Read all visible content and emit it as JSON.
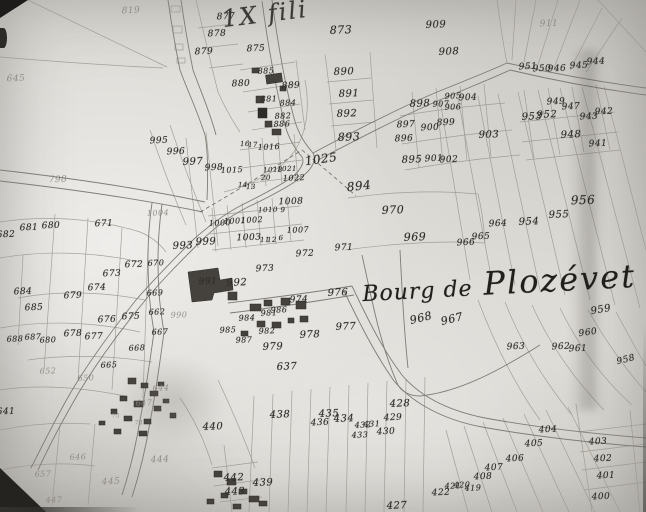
{
  "map": {
    "annotation_top": "1X fili",
    "place_label": {
      "prefix": "Bourg de",
      "name": "Plozévet"
    },
    "colors": {
      "paper": "#dedcd7",
      "ink": "#2f2d29",
      "faint": "#85827b",
      "line": "#98958c",
      "road": "#7f7c75"
    },
    "parcel_numbers": [
      {
        "t": "819",
        "x": 131,
        "y": 11,
        "f": true
      },
      {
        "t": "877",
        "x": 226,
        "y": 17
      },
      {
        "t": "873",
        "x": 341,
        "y": 30,
        "s": 11
      },
      {
        "t": "878",
        "x": 217,
        "y": 34
      },
      {
        "t": "875",
        "x": 256,
        "y": 49
      },
      {
        "t": "879",
        "x": 204,
        "y": 52
      },
      {
        "t": "909",
        "x": 436,
        "y": 25,
        "s": 10
      },
      {
        "t": "911",
        "x": 549,
        "y": 24,
        "f": true
      },
      {
        "t": "908",
        "x": 449,
        "y": 52,
        "s": 10
      },
      {
        "t": "645",
        "x": 16,
        "y": 79,
        "f": true
      },
      {
        "t": "890",
        "x": 344,
        "y": 72,
        "s": 10
      },
      {
        "t": "885",
        "x": 266,
        "y": 71,
        "s": 8
      },
      {
        "t": "880",
        "x": 241,
        "y": 84
      },
      {
        "t": "889",
        "x": 291,
        "y": 86
      },
      {
        "t": "881",
        "x": 269,
        "y": 99,
        "s": 8
      },
      {
        "t": "884",
        "x": 288,
        "y": 103,
        "s": 8
      },
      {
        "t": "882",
        "x": 283,
        "y": 116,
        "s": 8
      },
      {
        "t": "886",
        "x": 282,
        "y": 124,
        "s": 8
      },
      {
        "t": "891",
        "x": 349,
        "y": 94,
        "s": 10
      },
      {
        "t": "892",
        "x": 347,
        "y": 114,
        "s": 10
      },
      {
        "t": "893",
        "x": 349,
        "y": 137,
        "s": 11
      },
      {
        "t": "951",
        "x": 528,
        "y": 67
      },
      {
        "t": "950",
        "x": 542,
        "y": 69
      },
      {
        "t": "946",
        "x": 557,
        "y": 69
      },
      {
        "t": "945",
        "x": 579,
        "y": 66
      },
      {
        "t": "944",
        "x": 596,
        "y": 62
      },
      {
        "t": "949",
        "x": 556,
        "y": 102
      },
      {
        "t": "947",
        "x": 571,
        "y": 107
      },
      {
        "t": "953",
        "x": 532,
        "y": 117,
        "s": 10
      },
      {
        "t": "952",
        "x": 547,
        "y": 115,
        "s": 10
      },
      {
        "t": "943",
        "x": 589,
        "y": 117
      },
      {
        "t": "942",
        "x": 604,
        "y": 112
      },
      {
        "t": "948",
        "x": 571,
        "y": 135,
        "s": 10
      },
      {
        "t": "941",
        "x": 598,
        "y": 144
      },
      {
        "t": "898",
        "x": 420,
        "y": 104,
        "s": 10
      },
      {
        "t": "905",
        "x": 453,
        "y": 96,
        "s": 8
      },
      {
        "t": "904",
        "x": 468,
        "y": 98
      },
      {
        "t": "907",
        "x": 441,
        "y": 104,
        "s": 8
      },
      {
        "t": "906",
        "x": 453,
        "y": 107,
        "s": 8
      },
      {
        "t": "897",
        "x": 406,
        "y": 125
      },
      {
        "t": "899",
        "x": 446,
        "y": 123
      },
      {
        "t": "900",
        "x": 430,
        "y": 128
      },
      {
        "t": "896",
        "x": 404,
        "y": 139
      },
      {
        "t": "903",
        "x": 489,
        "y": 135,
        "s": 10
      },
      {
        "t": "895",
        "x": 412,
        "y": 160,
        "s": 10
      },
      {
        "t": "901",
        "x": 434,
        "y": 159
      },
      {
        "t": "902",
        "x": 449,
        "y": 160
      },
      {
        "t": "1025",
        "x": 321,
        "y": 159,
        "s": 12,
        "r": -8
      },
      {
        "t": "894",
        "x": 359,
        "y": 186,
        "s": 12,
        "r": -6
      },
      {
        "t": "995",
        "x": 159,
        "y": 141
      },
      {
        "t": "996",
        "x": 176,
        "y": 152
      },
      {
        "t": "997",
        "x": 193,
        "y": 162,
        "s": 10
      },
      {
        "t": "998",
        "x": 214,
        "y": 168
      },
      {
        "t": "1015",
        "x": 232,
        "y": 170,
        "s": 8
      },
      {
        "t": "16",
        "x": 245,
        "y": 144,
        "s": 7
      },
      {
        "t": "17",
        "x": 253,
        "y": 145,
        "s": 7
      },
      {
        "t": "1016",
        "x": 269,
        "y": 147,
        "s": 8
      },
      {
        "t": "1018",
        "x": 273,
        "y": 170,
        "s": 7
      },
      {
        "t": "1021",
        "x": 287,
        "y": 169,
        "s": 7
      },
      {
        "t": "20",
        "x": 266,
        "y": 178,
        "s": 7
      },
      {
        "t": "1022",
        "x": 294,
        "y": 178,
        "s": 8
      },
      {
        "t": "14",
        "x": 243,
        "y": 185,
        "s": 7
      },
      {
        "t": "13",
        "x": 251,
        "y": 187,
        "s": 7
      },
      {
        "t": "1008",
        "x": 291,
        "y": 202
      },
      {
        "t": "1010",
        "x": 268,
        "y": 210,
        "s": 7
      },
      {
        "t": "9",
        "x": 283,
        "y": 210,
        "s": 7
      },
      {
        "t": "1000",
        "x": 220,
        "y": 223,
        "s": 8
      },
      {
        "t": "1001",
        "x": 235,
        "y": 221,
        "s": 8
      },
      {
        "t": "1002",
        "x": 252,
        "y": 220,
        "s": 8
      },
      {
        "t": "11",
        "x": 265,
        "y": 240,
        "s": 7
      },
      {
        "t": "12",
        "x": 272,
        "y": 240,
        "s": 7
      },
      {
        "t": "6",
        "x": 281,
        "y": 238,
        "s": 7
      },
      {
        "t": "1007",
        "x": 298,
        "y": 230,
        "s": 8
      },
      {
        "t": "993",
        "x": 183,
        "y": 246,
        "s": 10
      },
      {
        "t": "999",
        "x": 206,
        "y": 242,
        "s": 10
      },
      {
        "t": "1003",
        "x": 249,
        "y": 238
      },
      {
        "t": "972",
        "x": 305,
        "y": 254
      },
      {
        "t": "973",
        "x": 265,
        "y": 269
      },
      {
        "t": "971",
        "x": 344,
        "y": 248
      },
      {
        "t": "970",
        "x": 393,
        "y": 210,
        "s": 11
      },
      {
        "t": "969",
        "x": 415,
        "y": 237,
        "s": 11
      },
      {
        "t": "966",
        "x": 466,
        "y": 243
      },
      {
        "t": "965",
        "x": 481,
        "y": 237
      },
      {
        "t": "964",
        "x": 498,
        "y": 224
      },
      {
        "t": "954",
        "x": 529,
        "y": 222,
        "s": 10
      },
      {
        "t": "955",
        "x": 559,
        "y": 215,
        "s": 10
      },
      {
        "t": "956",
        "x": 583,
        "y": 200,
        "s": 12
      },
      {
        "t": "798",
        "x": 58,
        "y": 180,
        "f": true
      },
      {
        "t": "1004",
        "x": 158,
        "y": 213,
        "s": 8,
        "f": true
      },
      {
        "t": "671",
        "x": 104,
        "y": 224
      },
      {
        "t": "681",
        "x": 29,
        "y": 228
      },
      {
        "t": "680",
        "x": 51,
        "y": 226
      },
      {
        "t": "682",
        "x": 6,
        "y": 235
      },
      {
        "t": "991",
        "x": 208,
        "y": 282
      },
      {
        "t": "992",
        "x": 237,
        "y": 283,
        "s": 10
      },
      {
        "t": "990",
        "x": 179,
        "y": 315,
        "s": 8,
        "f": true
      },
      {
        "t": "984",
        "x": 247,
        "y": 318,
        "s": 8
      },
      {
        "t": "981",
        "x": 269,
        "y": 313,
        "s": 8
      },
      {
        "t": "986",
        "x": 279,
        "y": 310,
        "s": 8
      },
      {
        "t": "985",
        "x": 228,
        "y": 330,
        "s": 8
      },
      {
        "t": "987",
        "x": 244,
        "y": 340,
        "s": 8
      },
      {
        "t": "982",
        "x": 267,
        "y": 331,
        "s": 8
      },
      {
        "t": "974",
        "x": 299,
        "y": 300
      },
      {
        "t": "976",
        "x": 338,
        "y": 293,
        "s": 10
      },
      {
        "t": "977",
        "x": 346,
        "y": 327,
        "s": 10
      },
      {
        "t": "978",
        "x": 310,
        "y": 335,
        "s": 10
      },
      {
        "t": "979",
        "x": 273,
        "y": 347,
        "s": 10
      },
      {
        "t": "637",
        "x": 287,
        "y": 367,
        "s": 10
      },
      {
        "t": "684",
        "x": 23,
        "y": 292
      },
      {
        "t": "685",
        "x": 34,
        "y": 308
      },
      {
        "t": "672",
        "x": 134,
        "y": 265
      },
      {
        "t": "673",
        "x": 112,
        "y": 274
      },
      {
        "t": "674",
        "x": 97,
        "y": 288
      },
      {
        "t": "679",
        "x": 73,
        "y": 296
      },
      {
        "t": "670",
        "x": 156,
        "y": 263,
        "s": 8
      },
      {
        "t": "669",
        "x": 155,
        "y": 293,
        "s": 8
      },
      {
        "t": "662",
        "x": 157,
        "y": 312,
        "s": 8
      },
      {
        "t": "676",
        "x": 107,
        "y": 320
      },
      {
        "t": "675",
        "x": 131,
        "y": 317
      },
      {
        "t": "667",
        "x": 160,
        "y": 332,
        "s": 8
      },
      {
        "t": "678",
        "x": 73,
        "y": 334
      },
      {
        "t": "677",
        "x": 94,
        "y": 337
      },
      {
        "t": "688",
        "x": 15,
        "y": 339,
        "s": 8
      },
      {
        "t": "687",
        "x": 33,
        "y": 337,
        "s": 8
      },
      {
        "t": "680",
        "x": 48,
        "y": 340,
        "s": 8
      },
      {
        "t": "668",
        "x": 137,
        "y": 348,
        "s": 8
      },
      {
        "t": "665",
        "x": 109,
        "y": 365,
        "s": 8
      },
      {
        "t": "652",
        "x": 48,
        "y": 371,
        "s": 8,
        "f": true
      },
      {
        "t": "650",
        "x": 86,
        "y": 378,
        "s": 8,
        "f": true
      },
      {
        "t": "641",
        "x": 6,
        "y": 412
      },
      {
        "t": "644",
        "x": 161,
        "y": 388,
        "s": 8,
        "f": true
      },
      {
        "t": "647",
        "x": 144,
        "y": 403,
        "s": 8,
        "f": true
      },
      {
        "t": "75",
        "x": 116,
        "y": 416,
        "s": 6,
        "f": true
      },
      {
        "t": "74",
        "x": 139,
        "y": 423,
        "s": 6,
        "f": true
      },
      {
        "t": "646",
        "x": 78,
        "y": 457,
        "s": 8,
        "f": true
      },
      {
        "t": "657",
        "x": 43,
        "y": 474,
        "s": 8,
        "f": true
      },
      {
        "t": "444",
        "x": 160,
        "y": 460,
        "f": true
      },
      {
        "t": "445",
        "x": 111,
        "y": 482,
        "f": true
      },
      {
        "t": "447",
        "x": 54,
        "y": 500,
        "s": 8,
        "f": true
      },
      {
        "t": "440",
        "x": 213,
        "y": 427,
        "s": 10
      },
      {
        "t": "438",
        "x": 280,
        "y": 415,
        "s": 10
      },
      {
        "t": "436",
        "x": 320,
        "y": 423
      },
      {
        "t": "435",
        "x": 329,
        "y": 414,
        "s": 10
      },
      {
        "t": "434",
        "x": 344,
        "y": 419,
        "s": 10
      },
      {
        "t": "432",
        "x": 363,
        "y": 425,
        "s": 8
      },
      {
        "t": "431",
        "x": 372,
        "y": 424,
        "s": 8
      },
      {
        "t": "433",
        "x": 360,
        "y": 435,
        "s": 8
      },
      {
        "t": "430",
        "x": 386,
        "y": 432
      },
      {
        "t": "429",
        "x": 393,
        "y": 418
      },
      {
        "t": "428",
        "x": 400,
        "y": 404,
        "s": 10
      },
      {
        "t": "442",
        "x": 234,
        "y": 478,
        "s": 10
      },
      {
        "t": "443",
        "x": 235,
        "y": 492,
        "s": 10
      },
      {
        "t": "439",
        "x": 263,
        "y": 483,
        "s": 10
      },
      {
        "t": "427",
        "x": 397,
        "y": 506,
        "s": 10
      },
      {
        "t": "422",
        "x": 441,
        "y": 493
      },
      {
        "t": "421",
        "x": 453,
        "y": 486,
        "s": 8
      },
      {
        "t": "420",
        "x": 462,
        "y": 485,
        "s": 8
      },
      {
        "t": "419",
        "x": 473,
        "y": 488,
        "s": 8
      },
      {
        "t": "408",
        "x": 483,
        "y": 477
      },
      {
        "t": "407",
        "x": 494,
        "y": 468
      },
      {
        "t": "406",
        "x": 515,
        "y": 459
      },
      {
        "t": "405",
        "x": 534,
        "y": 444
      },
      {
        "t": "404",
        "x": 548,
        "y": 430
      },
      {
        "t": "403",
        "x": 598,
        "y": 442
      },
      {
        "t": "402",
        "x": 603,
        "y": 459
      },
      {
        "t": "401",
        "x": 606,
        "y": 476
      },
      {
        "t": "400",
        "x": 601,
        "y": 497
      },
      {
        "t": "968",
        "x": 421,
        "y": 318,
        "s": 11,
        "r": -14
      },
      {
        "t": "967",
        "x": 452,
        "y": 319,
        "s": 11,
        "r": -14
      },
      {
        "t": "959",
        "x": 601,
        "y": 310,
        "s": 10,
        "r": -10
      },
      {
        "t": "960",
        "x": 588,
        "y": 333,
        "r": -8
      },
      {
        "t": "963",
        "x": 516,
        "y": 347
      },
      {
        "t": "962",
        "x": 561,
        "y": 347
      },
      {
        "t": "961",
        "x": 578,
        "y": 349
      },
      {
        "t": "958",
        "x": 626,
        "y": 360,
        "r": -14
      }
    ]
  }
}
